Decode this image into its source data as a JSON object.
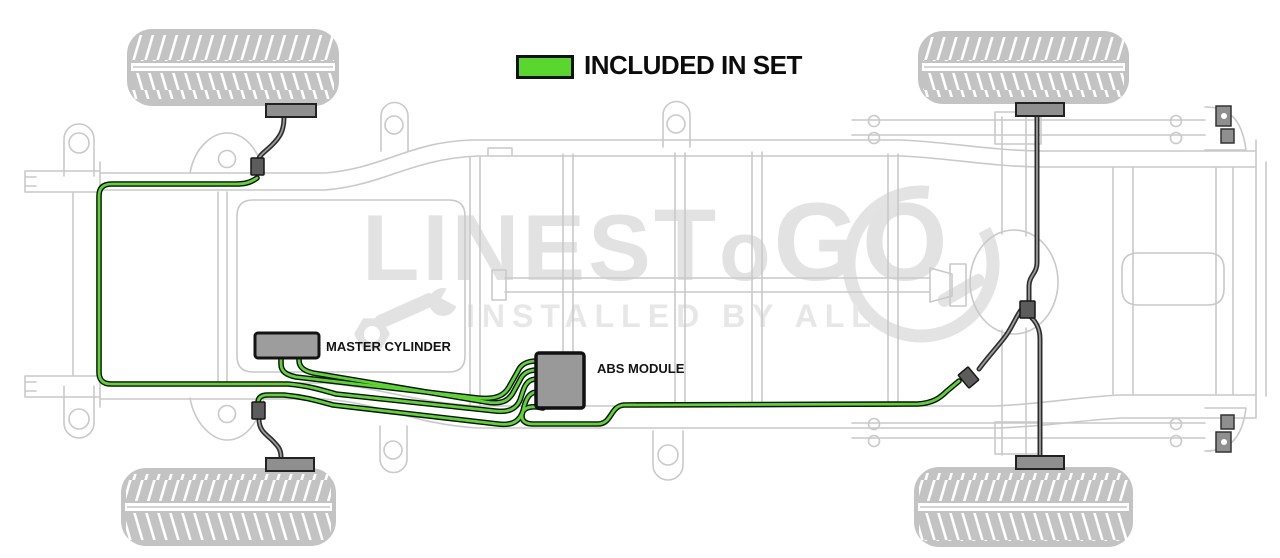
{
  "legend": {
    "label": "INCLUDED IN SET",
    "swatch_color": "#5ad72d"
  },
  "labels": {
    "master_cylinder": "MASTER CYLINDER",
    "abs_module": "ABS MODULE"
  },
  "watermark": {
    "brand": {
      "l1": "L",
      "l2": "INES",
      "l3": "T",
      "l4": "o",
      "l5": "G",
      "l6": "O"
    },
    "tagline": "INSTALLED BY ALL"
  },
  "colors": {
    "included_line": "#5ad72d",
    "other_lines": "#3c3c3c",
    "chassis_outline": "#c9c9c9",
    "label_text": "#111111",
    "watermark_gray": "#e2e2e2"
  }
}
